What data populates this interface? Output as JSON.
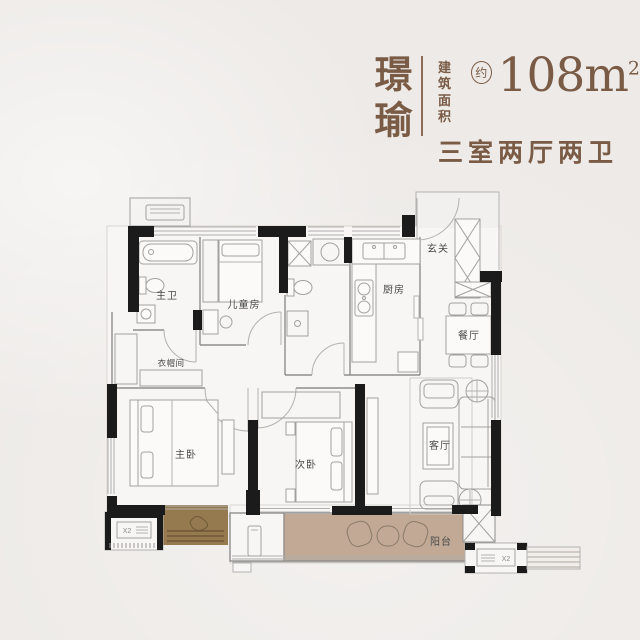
{
  "header": {
    "project_name": "璟瑜",
    "area_label_top": "建筑",
    "area_label_bottom": "面积",
    "approx": "约",
    "area_number": "108",
    "area_unit": "m",
    "area_superscript": "2",
    "layout_text": "三室两厅两卫",
    "accent_color": "#7a5b46"
  },
  "floorplan": {
    "rooms": [
      {
        "id": "master-bath",
        "label": "主卫"
      },
      {
        "id": "kids-room",
        "label": "儿童房"
      },
      {
        "id": "kitchen",
        "label": "厨房"
      },
      {
        "id": "foyer",
        "label": "玄关"
      },
      {
        "id": "dining-room",
        "label": "餐厅"
      },
      {
        "id": "cloakroom",
        "label": "衣帽间"
      },
      {
        "id": "master-bedroom",
        "label": "主卧"
      },
      {
        "id": "second-bedroom",
        "label": "次卧"
      },
      {
        "id": "living-room",
        "label": "客厅"
      },
      {
        "id": "balcony",
        "label": "阳台"
      }
    ],
    "ac_platform_label": "X2",
    "colors": {
      "wall": "#1b1b1b",
      "balcony_floor": "#c1a995",
      "planter": "#95794f",
      "room_label": "#4a4a4a"
    }
  }
}
